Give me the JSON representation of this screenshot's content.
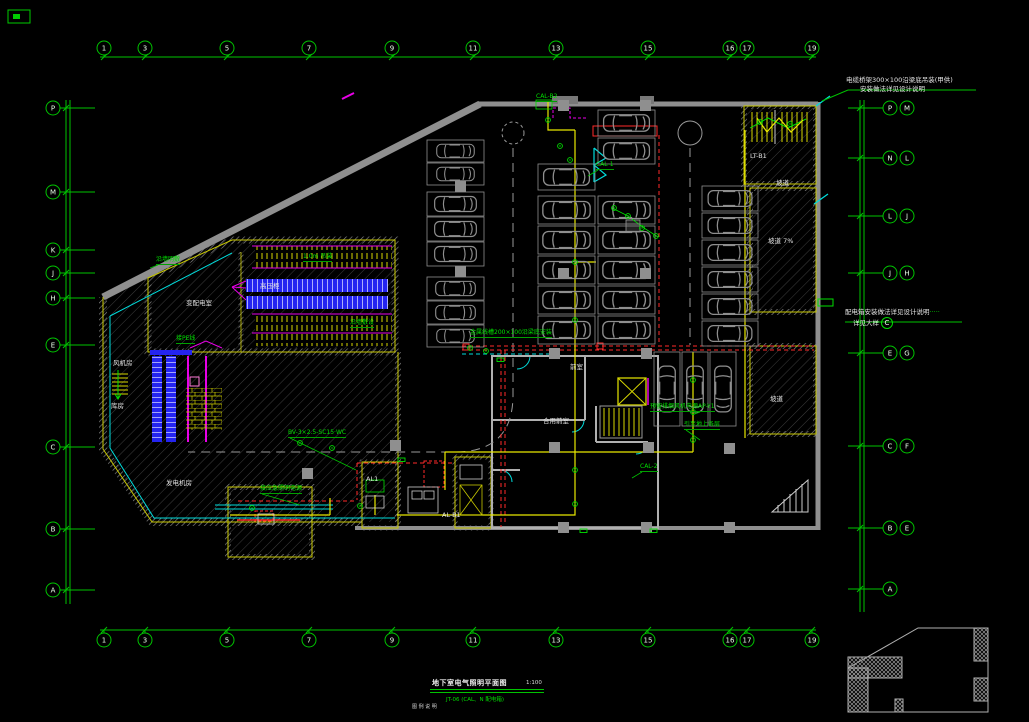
{
  "app": {
    "type": "cad-floor-plan",
    "background": "#000000"
  },
  "colors": {
    "grid": "#00c400",
    "device": "#00e000",
    "wall_gray": "#8f8f8f",
    "wall_yellow": "#c8c800",
    "wire_red": "#ff2a2a",
    "wire_yellow": "#e8e800",
    "equip_blue": "#2424f0",
    "accent_magenta": "#e800e8",
    "duct_cyan": "#00dcdc",
    "lane_gray": "#9a9a9a",
    "text_white": "#e2e2e2"
  },
  "grid": {
    "top": {
      "y": 48,
      "line_y": 57,
      "xs": [
        104,
        145,
        227,
        309,
        392,
        473,
        556,
        648,
        730,
        747,
        812
      ],
      "labels": [
        "1",
        "3",
        "5",
        "7",
        "9",
        "11",
        "13",
        "15",
        "16",
        "17",
        "19"
      ]
    },
    "bottom": {
      "y": 640,
      "line_y": 630,
      "xs": [
        104,
        145,
        227,
        309,
        392,
        473,
        556,
        648,
        730,
        747,
        812
      ],
      "labels": [
        "1",
        "3",
        "5",
        "7",
        "9",
        "11",
        "13",
        "15",
        "16",
        "17",
        "19"
      ]
    },
    "left": {
      "cx": 53,
      "line_x": 66,
      "items": [
        {
          "label": "P",
          "y": 108
        },
        {
          "label": "M",
          "y": 192
        },
        {
          "label": "K",
          "y": 250
        },
        {
          "label": "J",
          "y": 273
        },
        {
          "label": "H",
          "y": 298
        },
        {
          "label": "E",
          "y": 345
        },
        {
          "label": "C",
          "y": 447
        },
        {
          "label": "B",
          "y": 529
        },
        {
          "label": "A",
          "y": 590
        }
      ]
    },
    "right": {
      "cx": 890,
      "cx2": 907,
      "line_x": 860,
      "items": [
        {
          "labels": [
            "P",
            "M"
          ],
          "y": 108
        },
        {
          "labels": [
            "N",
            "L"
          ],
          "y": 158
        },
        {
          "labels": [
            "L",
            "J"
          ],
          "y": 216
        },
        {
          "labels": [
            "J",
            "H"
          ],
          "y": 273
        },
        {
          "labels": [
            "E",
            "G"
          ],
          "y": 353
        },
        {
          "labels": [
            "C",
            "F"
          ],
          "y": 446
        },
        {
          "labels": [
            "B",
            "E"
          ],
          "y": 528
        },
        {
          "labels": [
            "A"
          ],
          "y": 589
        }
      ]
    }
  },
  "annotations": {
    "top_right": {
      "line1": "电缆桥架300×100沿梁底吊装(甲供)",
      "line2": "安装做法详见设计说明"
    },
    "mid_right": {
      "line1": "配电箱安装做法详见设计说明",
      "dots": "·····",
      "line2": "详见大样",
      "detail_ref": "C"
    }
  },
  "title_block": {
    "title": "地下室电气照明平面图",
    "scale": "1:100",
    "note": "JT-06 (CAL、N 配电箱)",
    "sub": "图 例  说 明"
  },
  "labels": [
    {
      "t": "变配电室",
      "c": "w",
      "x": 186,
      "y": 300
    },
    {
      "t": "高压柜",
      "c": "w",
      "x": 260,
      "y": 283
    },
    {
      "t": "发电机房",
      "c": "w",
      "x": 166,
      "y": 480
    },
    {
      "t": "库房",
      "c": "w",
      "x": 111,
      "y": 403
    },
    {
      "t": "风机房",
      "c": "w",
      "x": 113,
      "y": 360
    },
    {
      "t": "前室",
      "c": "w",
      "x": 570,
      "y": 364
    },
    {
      "t": "合用前室",
      "c": "w",
      "x": 543,
      "y": 418
    },
    {
      "t": "坡道",
      "c": "w",
      "x": 776,
      "y": 180
    },
    {
      "t": "坡道 7%",
      "c": "w",
      "x": 768,
      "y": 238
    },
    {
      "t": "坡道",
      "c": "w",
      "x": 770,
      "y": 396
    },
    {
      "t": "LT-B1",
      "c": "w",
      "x": 750,
      "y": 153
    },
    {
      "t": "AL-B1",
      "c": "w",
      "x": 442,
      "y": 512
    },
    {
      "t": "AL1",
      "c": "w",
      "x": 366,
      "y": 476
    },
    {
      "t": "CAL-1",
      "c": "g",
      "x": 596,
      "y": 162,
      "lx": 588,
      "ly": 176
    },
    {
      "t": "CAL-2",
      "c": "g",
      "x": 640,
      "y": 464,
      "lx": 632,
      "ly": 478
    },
    {
      "t": "AP-Y1",
      "c": "g",
      "x": 698,
      "y": 404,
      "lx": 692,
      "ly": 415
    },
    {
      "t": "BV-3×2.5-SC15·WC",
      "c": "g",
      "x": 288,
      "y": 430,
      "lx": 356,
      "ly": 470
    },
    {
      "t": "接应急照明电源",
      "c": "g",
      "x": 260,
      "y": 486,
      "lx": 300,
      "ly": 505
    },
    {
      "t": "金属线槽200×100沿梁底安装",
      "c": "g",
      "x": 470,
      "y": 330
    },
    {
      "t": "预留排烟风机电源",
      "c": "g",
      "x": 650,
      "y": 404
    },
    {
      "t": "引至地上各层",
      "c": "g",
      "x": 684,
      "y": 422,
      "lx": 700,
      "ly": 440
    },
    {
      "t": "沿墙明敷",
      "c": "g",
      "x": 156,
      "y": 257,
      "lx": 150,
      "ly": 268
    },
    {
      "t": "1.0m 吊装",
      "c": "g",
      "x": 303,
      "y": 254
    },
    {
      "t": "沿墙敷设",
      "c": "g",
      "x": 350,
      "y": 320
    },
    {
      "t": "CAL-B2",
      "c": "g",
      "x": 536,
      "y": 94
    },
    {
      "t": "接PE线",
      "c": "g",
      "x": 176,
      "y": 336
    }
  ],
  "parking": {
    "stalls": [
      {
        "x": 427,
        "y": 140,
        "w": 57,
        "h": 22,
        "dir": "h"
      },
      {
        "x": 427,
        "y": 163,
        "w": 57,
        "h": 22,
        "dir": "h"
      },
      {
        "x": 427,
        "y": 192,
        "w": 57,
        "h": 24,
        "dir": "h"
      },
      {
        "x": 427,
        "y": 217,
        "w": 57,
        "h": 24,
        "dir": "h"
      },
      {
        "x": 427,
        "y": 242,
        "w": 57,
        "h": 24,
        "dir": "h"
      },
      {
        "x": 427,
        "y": 277,
        "w": 57,
        "h": 23,
        "dir": "h"
      },
      {
        "x": 427,
        "y": 301,
        "w": 57,
        "h": 23,
        "dir": "h"
      },
      {
        "x": 427,
        "y": 325,
        "w": 57,
        "h": 22,
        "dir": "h"
      },
      {
        "x": 538,
        "y": 164,
        "w": 57,
        "h": 26,
        "dir": "h"
      },
      {
        "x": 538,
        "y": 196,
        "w": 57,
        "h": 28,
        "dir": "h"
      },
      {
        "x": 538,
        "y": 226,
        "w": 57,
        "h": 28,
        "dir": "h"
      },
      {
        "x": 538,
        "y": 256,
        "w": 57,
        "h": 28,
        "dir": "h"
      },
      {
        "x": 538,
        "y": 286,
        "w": 57,
        "h": 28,
        "dir": "h"
      },
      {
        "x": 538,
        "y": 316,
        "w": 57,
        "h": 28,
        "dir": "h"
      },
      {
        "x": 598,
        "y": 110,
        "w": 57,
        "h": 26,
        "dir": "h"
      },
      {
        "x": 598,
        "y": 138,
        "w": 57,
        "h": 26,
        "dir": "h"
      },
      {
        "x": 598,
        "y": 196,
        "w": 57,
        "h": 28,
        "dir": "h"
      },
      {
        "x": 598,
        "y": 226,
        "w": 57,
        "h": 28,
        "dir": "h"
      },
      {
        "x": 598,
        "y": 256,
        "w": 57,
        "h": 28,
        "dir": "h"
      },
      {
        "x": 598,
        "y": 286,
        "w": 57,
        "h": 28,
        "dir": "h"
      },
      {
        "x": 598,
        "y": 316,
        "w": 57,
        "h": 28,
        "dir": "h"
      },
      {
        "x": 702,
        "y": 186,
        "w": 56,
        "h": 25,
        "dir": "h"
      },
      {
        "x": 702,
        "y": 213,
        "w": 56,
        "h": 25,
        "dir": "h"
      },
      {
        "x": 702,
        "y": 240,
        "w": 56,
        "h": 25,
        "dir": "h"
      },
      {
        "x": 702,
        "y": 267,
        "w": 56,
        "h": 25,
        "dir": "h"
      },
      {
        "x": 702,
        "y": 294,
        "w": 56,
        "h": 25,
        "dir": "h"
      },
      {
        "x": 702,
        "y": 321,
        "w": 56,
        "h": 25,
        "dir": "h"
      },
      {
        "x": 654,
        "y": 352,
        "w": 26,
        "h": 74,
        "dir": "v"
      },
      {
        "x": 682,
        "y": 352,
        "w": 26,
        "h": 74,
        "dir": "v"
      },
      {
        "x": 710,
        "y": 352,
        "w": 26,
        "h": 74,
        "dir": "v"
      }
    ]
  },
  "structure": {
    "columns": [
      [
        558,
        100
      ],
      [
        640,
        100
      ],
      [
        455,
        181
      ],
      [
        455,
        266
      ],
      [
        558,
        268
      ],
      [
        640,
        268
      ],
      [
        549,
        348
      ],
      [
        641,
        348
      ],
      [
        549,
        442
      ],
      [
        643,
        442
      ],
      [
        724,
        443
      ],
      [
        390,
        440
      ],
      [
        302,
        468
      ],
      [
        558,
        522
      ],
      [
        641,
        522
      ],
      [
        724,
        522
      ]
    ]
  },
  "devices": {
    "points": [
      [
        548,
        120
      ],
      [
        560,
        146
      ],
      [
        570,
        160
      ],
      [
        614,
        208
      ],
      [
        628,
        216
      ],
      [
        642,
        228
      ],
      [
        656,
        236
      ],
      [
        470,
        348
      ],
      [
        486,
        351
      ],
      [
        575,
        262
      ],
      [
        575,
        320
      ],
      [
        693,
        380
      ],
      [
        693,
        412
      ],
      [
        693,
        440
      ],
      [
        300,
        443
      ],
      [
        332,
        448
      ],
      [
        252,
        508
      ],
      [
        360,
        506
      ],
      [
        760,
        122
      ],
      [
        790,
        124
      ],
      [
        575,
        470
      ],
      [
        575,
        504
      ]
    ],
    "exits": [
      [
        497,
        358
      ],
      [
        580,
        529
      ],
      [
        650,
        529
      ],
      [
        398,
        458
      ]
    ]
  }
}
